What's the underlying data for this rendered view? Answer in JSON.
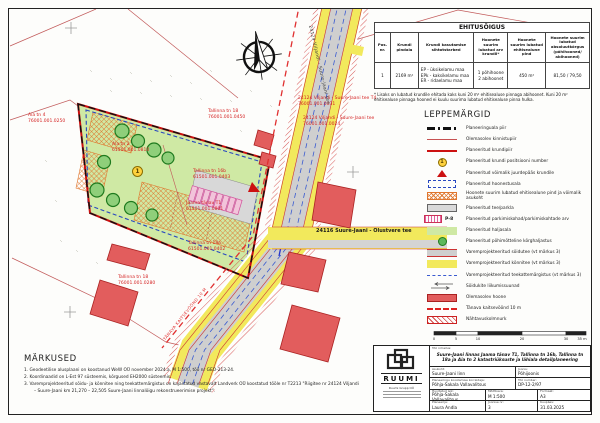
{
  "ehitusoigus": {
    "title": "EHITUSÕIGUS",
    "headers": [
      "Pos. nr.",
      "Krundi pindala",
      "Krundi kasutamise sihtotstarbed",
      "Hoonete suurim lubatud arv krundil*",
      "Hoonete suurim lubatud ehitisealune pind",
      "Hoonete suurim lubatud absoluutkõrgus (põhihooned/ abihooned)"
    ],
    "row": {
      "pos": "1",
      "pindala": "2169 m²",
      "sihtotstarbed": [
        "EP - üksikelamu maa",
        "EPk - kaksikelamu maa",
        "ER - ridaelamu maa"
      ],
      "arv": [
        "1 põhihoone",
        "2 abihoonet"
      ],
      "pind": "450 m²",
      "korgus": "81,50 / 79,50"
    },
    "footnote": "* Lisaks on lubatud krundile ehitada kaks kuni 20 m² ehitisealuse pinnaga abihoonet. Kuni 20 m² ehitisealuse pinnaga hooned ei kuulu suurima lubatud ehitisealuse pinna hulka."
  },
  "legend": {
    "title": "LEPPEMÄRGID",
    "p_label": "P-8",
    "items": [
      {
        "label": "Planeeringuala piir"
      },
      {
        "label": "Olemasolev kinnistupiir"
      },
      {
        "label": "Planeeritud krundipiir"
      },
      {
        "label": "Planeeritud krundi positsiooni number"
      },
      {
        "label": "Planeeritud võimalik juurdepääs krundile"
      },
      {
        "label": "Planeeritud hoonestusala"
      },
      {
        "label": "Hoonete suurim lubatud ehitisealune pind ja võimalik asukoht"
      },
      {
        "label": "Planeeritud tee/parkla"
      },
      {
        "label": "Planeeritud parkimiskohad/parkimiskohtade arv"
      },
      {
        "label": "Planeeritud haljasala"
      },
      {
        "label": "Planeeritud põhimõtteline kõrghaljastus"
      },
      {
        "label": "Varemprojekteeritud sõidutee (vt märkus 3)"
      },
      {
        "label": "Varemprojekteeritud kõnnitee (vt märkus 3)"
      },
      {
        "label": "Varemprojekteeritud teekattemärgistus (vt märkus 3)"
      },
      {
        "label": "Sõidukite liikumissuunad"
      },
      {
        "label": "Olemasolev hoone"
      },
      {
        "label": "Tänava kaitsevöönd 10 m"
      },
      {
        "label": "Nähtavuskolmnurk"
      }
    ]
  },
  "markused": {
    "title": "MÄRKUSED",
    "notes": [
      "1.  Geodeetilise alusplaani on koostanud WeW OÜ november 2024.a, M 1:500, töö nr GEO-213-24.",
      "2.  Koordinaadid on L-Est 97 süsteemis, kõrgused EH2000 süsteemis.",
      "3.  Varemprojekteeritud sõidu- ja kõnnitee ning teekattemärgistus on kajastatud vastavalt Landverk OÜ koostatud tööle nr T2213 \"Riigitee nr 24124 Viljandi – Suure-Jaani km 21,270 – 22,505 Suure-Jaani linnalõigu rekonstrueerimise projekt\"."
    ]
  },
  "scalebar": {
    "labels": [
      "0",
      "5",
      "10",
      "20",
      "30",
      "35 m"
    ]
  },
  "titleblock": {
    "logo_text": "RUUMI",
    "logo_sub": "Ruumi Grupp OÜ",
    "too_nimetus_label": "Töö nimetus:",
    "too_nimetus": "Suure-Jaani linnas Jaama tänav T1, Tallinna tn 16b, Tallinna tn 18a ja Aia tn 2 katastriüksuste ja lähiala detailplaneering",
    "asukoht_label": "Asukoht:",
    "asukoht": "Suure-Jaani linn",
    "joonis_label": "Joonis:",
    "joonis": "Põhijoonis",
    "korraldaja_label": "Planeeringu koostamise korraldaja:",
    "korraldaja": "Põhja-Sakala Vallavalitsus",
    "too_number_label": "Töö number:",
    "too_number": "DP-12-2/97",
    "huvitatud_label": "Huvitatud isik:",
    "huvitatud": "Põhja-Sakala Vallavalitsus",
    "mootkava_label": "Mõõtkava:",
    "mootkava": "M 1:500",
    "formaat_label": "Formaat:",
    "formaat": "A3",
    "planeerija_label": "Planeerija:",
    "planeerija": "Laura Andla",
    "joonise_nr_label": "Joonise nr:",
    "joonise_nr": "3",
    "kuupaev_label": "Kuupäev:",
    "kuupaev": "31.03.2025"
  },
  "map": {
    "position_number": "1",
    "road_label_rotated": "24124 Viljandi - Suure-Jaani tee",
    "olustvere_label": "24116 Suure-Jaani - Olustvere tee",
    "kaitsevoond_label": "TÄNAVA KAITSEVÖÖND 10 M",
    "labels": [
      {
        "name": "Aia tn 4",
        "code": "76001.001.0250"
      },
      {
        "name": "Aia tn 2",
        "code": "61501.001.0810"
      },
      {
        "name": "Tallinna tn 18",
        "code": "76001.001.0450"
      },
      {
        "name": "Tallinna tn 16b",
        "code": "61501.001.0403"
      },
      {
        "name": "Jaama tänav T1",
        "code": "61501.001.0801"
      },
      {
        "name": "Tallinna tn 18a",
        "code": "61501.001.0402"
      },
      {
        "name": "Tallinna tn 18",
        "code": "76001.001.0280"
      },
      {
        "name": "24124 Viljandi - Suure-Jaani tee T4",
        "code": "76001.001.0031"
      },
      {
        "name": "24124 Viljandi - Suure-Jaani tee",
        "code": "76001.001.0024"
      }
    ]
  }
}
